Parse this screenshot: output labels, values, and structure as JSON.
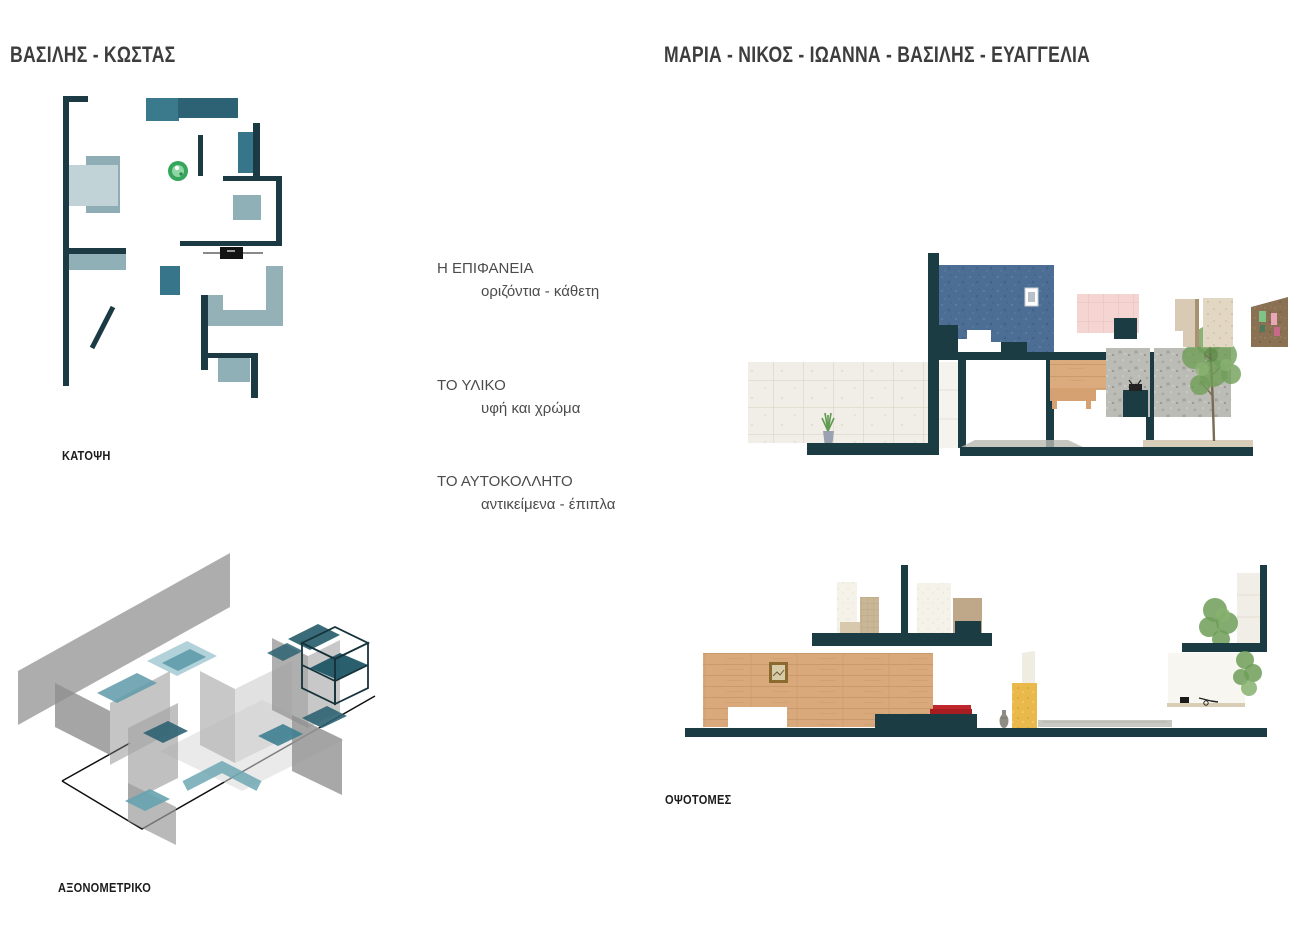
{
  "header": {
    "left_title": "ΒΑΣΙΛΗΣ - ΚΩΣΤΑΣ",
    "right_title": "ΜΑΡΙΑ - ΝΙΚΟΣ - ΙΩΑΝΝΑ - ΒΑΣΙΛΗΣ - ΕΥΑΓΓΕΛΙΑ"
  },
  "labels": {
    "plan": "ΚΑΤΟΨΗ",
    "axonometric": "ΑΞΟΝΟΜΕΤΡΙΚΟ",
    "sections": "ΟΨΟΤΟΜΕΣ"
  },
  "concepts": [
    {
      "title": "Η ΕΠΙΦΑΝΕΙΑ",
      "subtitle": "οριζόντια - κάθετη"
    },
    {
      "title": "ΤΟ ΥΛΙΚΟ",
      "subtitle": "υφή και χρώμα"
    },
    {
      "title": "ΤΟ ΑΥΤΟΚΟΛΛΗΤΟ",
      "subtitle": "αντικείμενα - έπιπλα"
    }
  ],
  "palette": {
    "wall_dark_teal": "#1c3c44",
    "teal_medium": "#37768a",
    "teal_muted": "#8fb0b6",
    "teal_pale": "#c2d3d8",
    "blue_wall": "#4c6e94",
    "pink_tile": "#f4d5d1",
    "wood": "#dcab7d",
    "cream_tile": "#f0eee6",
    "concrete": "#bcbcb6",
    "tree_green": "#6f9e58",
    "yellow_block": "#e9b94b",
    "red_books": "#b01f24",
    "cork_brown": "#8a7154"
  }
}
